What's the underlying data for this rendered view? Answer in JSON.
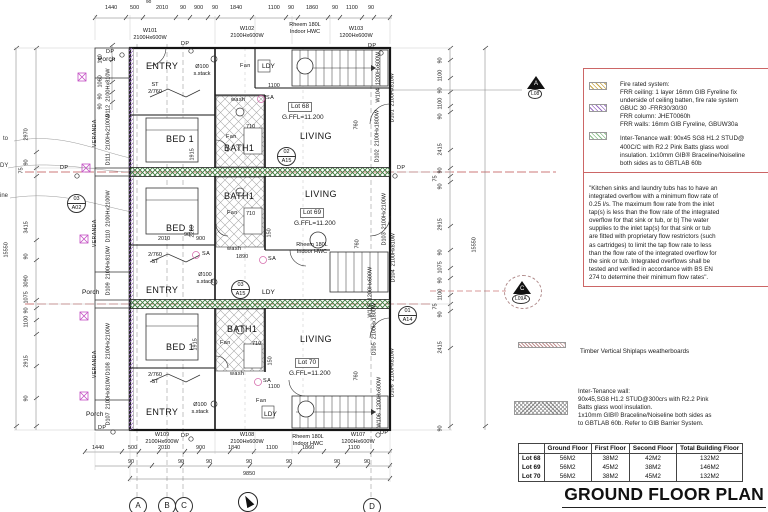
{
  "title": "GROUND FLOOR PLAN",
  "colors": {
    "note_border": "#cc5555",
    "hatch_green": "#3f7d3f",
    "hatch_purple": "#9b6fc4",
    "centerline_red": "#cc7a7a",
    "symbol_magenta": "#c44fc4"
  },
  "legend": {
    "fire": "Fire rated system:\nFRR ceiling: 1 layer 16mm GIB Fyreline fix\nunderside of ceiling batten, fire rate system\nGBUC 30 -FRR30/30/30\nFRR column: JHET0060h\nFRR walls: 16mm GIB Fyreline, GBUW30a",
    "intertenancy": "Inter-Tenance wall: 90x45 SG8 H1.2 STUD@\n400C/C with R2.2 Pink Batts glass wool\ninsulation. 1x10mm GIB® Braceline/Noiseline\nboth sides as to GBTLAB 60b"
  },
  "notes": {
    "kitchen": "\"Kitchen sinks and laundry tubs has to have an\nintegrated overflow with a minimum flow rate of\n0.25 l/s. The maximum flow rate from the inlet\ntap(s) is less than the flow rate of the integrated\noverflow for that sink or tub, or b) The water\nsupplies to the inlet tap(s) for that sink or tub\nare fitted with proprietary flow restrictors (such\nas cartridges) to limit the tap flow rate to less\nthan the flow rate of the integrated overflow for\nthe sink or tub. Integrated overflows shall be\ntested and verified in accordance with BS EN\n274 to determine their minimum flow rates\".",
    "timber": "Timber Vertical Shiplaps weatherboards",
    "intertenancy2": "Inter-Tenance wall:\n90x45,SG8 H1.2 STUD@300crs with R2.2 Pink\nBatts glass wool insulation.\n1x10mm GIB® Braceline/Noiseline both sides as\nto GBTLAB 60b. Refer to GIB Barrier System."
  },
  "table": {
    "headers": [
      "",
      "Ground Floor",
      "First Floor",
      "Second Floor",
      "Total Building Floor"
    ],
    "rows": [
      [
        "Lot 68",
        "56M2",
        "38M2",
        "42M2",
        "132M2"
      ],
      [
        "Lot 69",
        "56M2",
        "45M2",
        "38M2",
        "146M2"
      ],
      [
        "Lot 70",
        "56M2",
        "38M2",
        "45M2",
        "132M2"
      ]
    ]
  },
  "labels": {
    "entry": "ENTRY",
    "bed": "BED 1",
    "bath": "BATH1",
    "living": "LIVING",
    "veranda": "VERANDA",
    "porch": "Porch",
    "ldy": "LDY",
    "st": "ST",
    "st2": "2/760",
    "fan": "Fan",
    "wash": "wash",
    "sa": "SA",
    "dp": "DP",
    "stack1": "Ø100",
    "stack2": "s.stack",
    "hwc1": "Rheem 180L",
    "hwc2": "Indoor HWC"
  },
  "tags": {
    "w101": "W101",
    "w102": "W102",
    "w103": "W103",
    "w104": "W104",
    "w105": "W105",
    "w106": "W106",
    "w107": "W107",
    "w108": "W108",
    "w109": "W109",
    "d101": "D101",
    "d102": "D102",
    "d103": "D103",
    "d104": "D104",
    "d105": "D105",
    "d106": "D106",
    "d107": "D107",
    "d108": "D108",
    "d109": "D109",
    "d110": "D110",
    "d111": "D111",
    "d112": "D112"
  },
  "sizes": {
    "a": "2100Hx600W",
    "b": "1200Hx600W",
    "c": "2100Hx810W",
    "d": "2100Hx2100W",
    "e": "2100Hx1800W"
  },
  "dims": {
    "d90": "90",
    "d75": "75",
    "d140": "140",
    "d150": "150",
    "d500": "500",
    "d710": "710",
    "d760": "760",
    "d900": "900",
    "d1060": "1060",
    "d1075": "1075",
    "d1100": "1100",
    "d1440": "1440",
    "d1840": "1840",
    "d1860": "1860",
    "d1890": "1890",
    "d1915": "1915",
    "d2010": "2010",
    "d2285": "2285",
    "d2415": "2415",
    "d2915": "2915",
    "d2970": "2970",
    "d3090": "3090",
    "d3415": "3415",
    "d9850": "9850",
    "d15550": "15550"
  },
  "lots": {
    "l68": {
      "id": "Lot 68",
      "ffl": "G.FFL=11.200"
    },
    "l69": {
      "id": "Lot 69",
      "ffl": "G.FFL=11.200"
    },
    "l70": {
      "id": "Lot 70",
      "ffl": "G.FFL=11.200"
    }
  },
  "markers": {
    "m1": {
      "t": "02",
      "b": "A15"
    },
    "m2": {
      "t": "03",
      "b": "A15"
    },
    "m3": {
      "t": "03",
      "b": "A02"
    },
    "m4": {
      "t": "01",
      "b": "A14"
    },
    "l08": {
      "t": "A",
      "b": "L08"
    },
    "l09": {
      "t": "C",
      "b": "L09A"
    }
  },
  "grid": {
    "a": "A",
    "b": "B",
    "c": "C",
    "d": "D"
  },
  "frags": {
    "f1": "to",
    "f2": "DY",
    "f3": "ine"
  }
}
